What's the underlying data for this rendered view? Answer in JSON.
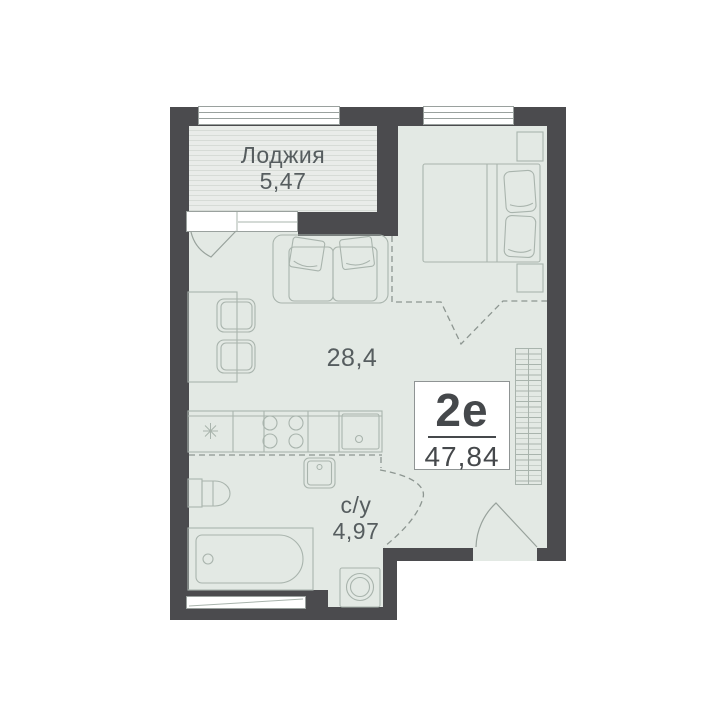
{
  "plan": {
    "loggia": {
      "label": "Лоджия",
      "area": "5,47"
    },
    "living_room": {
      "area": "28,4"
    },
    "bathroom": {
      "label": "с/у",
      "area": "4,97"
    },
    "unit_badge": {
      "type": "2е",
      "total_area": "47,84"
    },
    "icons": {
      "fridge-icon": "snowflake-asterisk",
      "stove-icon": "four-burner-circles",
      "kitchen-sink-icon": "square-with-drain-circle",
      "bathroom-sink-icon": "square-with-tap-circle",
      "toilet-icon": "tank-and-bowl",
      "bathtub-icon": "tub-with-drain",
      "washing-machine-icon": "square-with-drum-circle",
      "radiator-icon": "hatched-strip",
      "door-swing-icon": "quarter-arc",
      "zone-boundary-icon": "dashed-line"
    },
    "colors": {
      "wall": "#4b4b4e",
      "floor": "#e3e9e4",
      "loggia_floor": "#e9ece9",
      "loggia_hatch": "#d6dbd6",
      "line": "#a9b4ad",
      "door": "#98a29c",
      "dash": "#8d9691",
      "text": "#565d5f",
      "badge_text": "#45484b",
      "badge_border": "#8f9494",
      "win_border": "#9aa19e"
    }
  }
}
